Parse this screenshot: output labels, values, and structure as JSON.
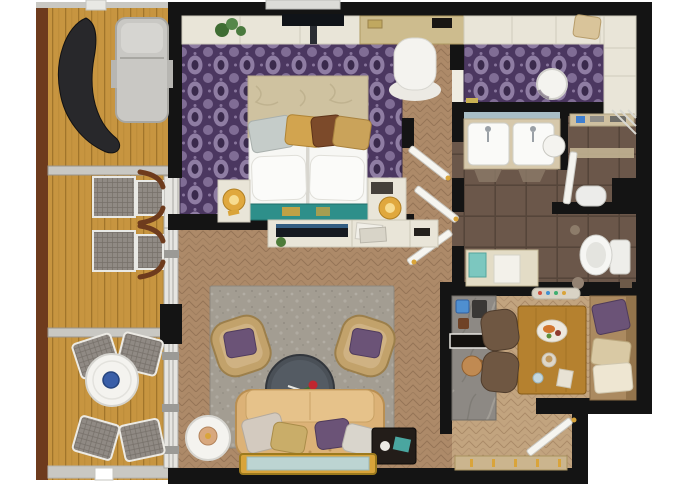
{
  "meta": {
    "title": "Hotel suite floor plan — top-down 3D render"
  },
  "colors": {
    "wall": "#141414",
    "lightwall": "#c9c8c3",
    "win": "#e6e5e1",
    "win_line": "#a8a7a2",
    "deck": "#c79540",
    "deck_line": "#a1752b",
    "deck_rail": "#6e3b1d",
    "lounger": "#c9c8c4",
    "dark_furn": "#28282b",
    "wicker": "#908a84",
    "wicker_line": "#6e6962",
    "bowl_blue": "#3a5fa8",
    "floor_base": "#efece1",
    "cream": "#e9e5d8",
    "desk": "#cdbc8e",
    "carpet": "#4b3760",
    "carpet_motif": "#9785ab",
    "carpet_deep": "#3a2a4c",
    "wood": "#ad8a69",
    "wood_line": "#8f6f52",
    "wood_k": "#c2a47f",
    "wood_k_line": "#a58563",
    "tile": "#6b574a",
    "tile_line": "#55453a",
    "marble": "#8d8984",
    "marble_vein": "#aaa69f",
    "rug": "#a39d92",
    "teal": "#2e8f8a",
    "gold": "#d9a43a",
    "bed_cover": "#cfc2a0",
    "purple_pillow": "#6b5377",
    "sofa": "#dcb277",
    "sofa_line": "#b98f52",
    "table_wood": "#b5812f",
    "chair_brown": "#6f5742",
    "banquette": "#ab8a60",
    "white_fix": "#f4f3ef"
  },
  "rooms": [
    {
      "id": "deck",
      "label": "Terrace deck"
    },
    {
      "id": "bedroom",
      "label": "Bedroom"
    },
    {
      "id": "dressing",
      "label": "Walk-in closet"
    },
    {
      "id": "hall",
      "label": "Hallway"
    },
    {
      "id": "bathroom",
      "label": "Bathroom"
    },
    {
      "id": "shower",
      "label": "Shower room"
    },
    {
      "id": "wc",
      "label": "WC"
    },
    {
      "id": "living",
      "label": "Living room"
    },
    {
      "id": "kitchen",
      "label": "Kitchen and dining"
    },
    {
      "id": "entry",
      "label": "Entry"
    }
  ],
  "furniture": {
    "hanging_lounger": "curved lounge chair",
    "sun_lounger": "sun lounger",
    "deck_chairs": "pair of woven deck chairs",
    "patio_table": "round patio table with blue bowl",
    "patio_chairs": "four woven patio chairs",
    "console": "wall console with plant",
    "tv_bedroom": "wall-mounted TV",
    "desk": "vanity desk",
    "desk_chair": "white desk chair",
    "bed": "double bed with pillows",
    "runner": "teal bed runner",
    "nightstand_left": "left nightstand with lamp",
    "nightstand_right": "right nightstand with lamp",
    "wardrobes": "built-in wardrobes",
    "pouf": "round white pouf",
    "vanity": "double basin vanity",
    "shower_shelf": "shower shelf",
    "shower_door": "shower glass door",
    "bidet": "bidet",
    "toilet": "toilet",
    "bath_bench": "bench with towels",
    "door_leaf": "open door leaf",
    "counter": "marble kitchen counter",
    "dining_table": "wooden dining table with food",
    "dining_chairs": "two dining chairs",
    "banquette": "banquette bench with cushions",
    "doormat": "entry doormat",
    "sideboard": "media sideboard",
    "tv_living": "flat-screen TV",
    "rug": "grey area rug",
    "armchair_left": "wicker armchair with purple cushion",
    "armchair_right": "wicker armchair with purple cushion",
    "coffee_table": "round coffee table with rose",
    "sofa": "tufted beige sofa",
    "side_table_round": "round side table with lamp",
    "side_table_dark": "dark side table",
    "bench_gold": "gold-framed bench"
  }
}
